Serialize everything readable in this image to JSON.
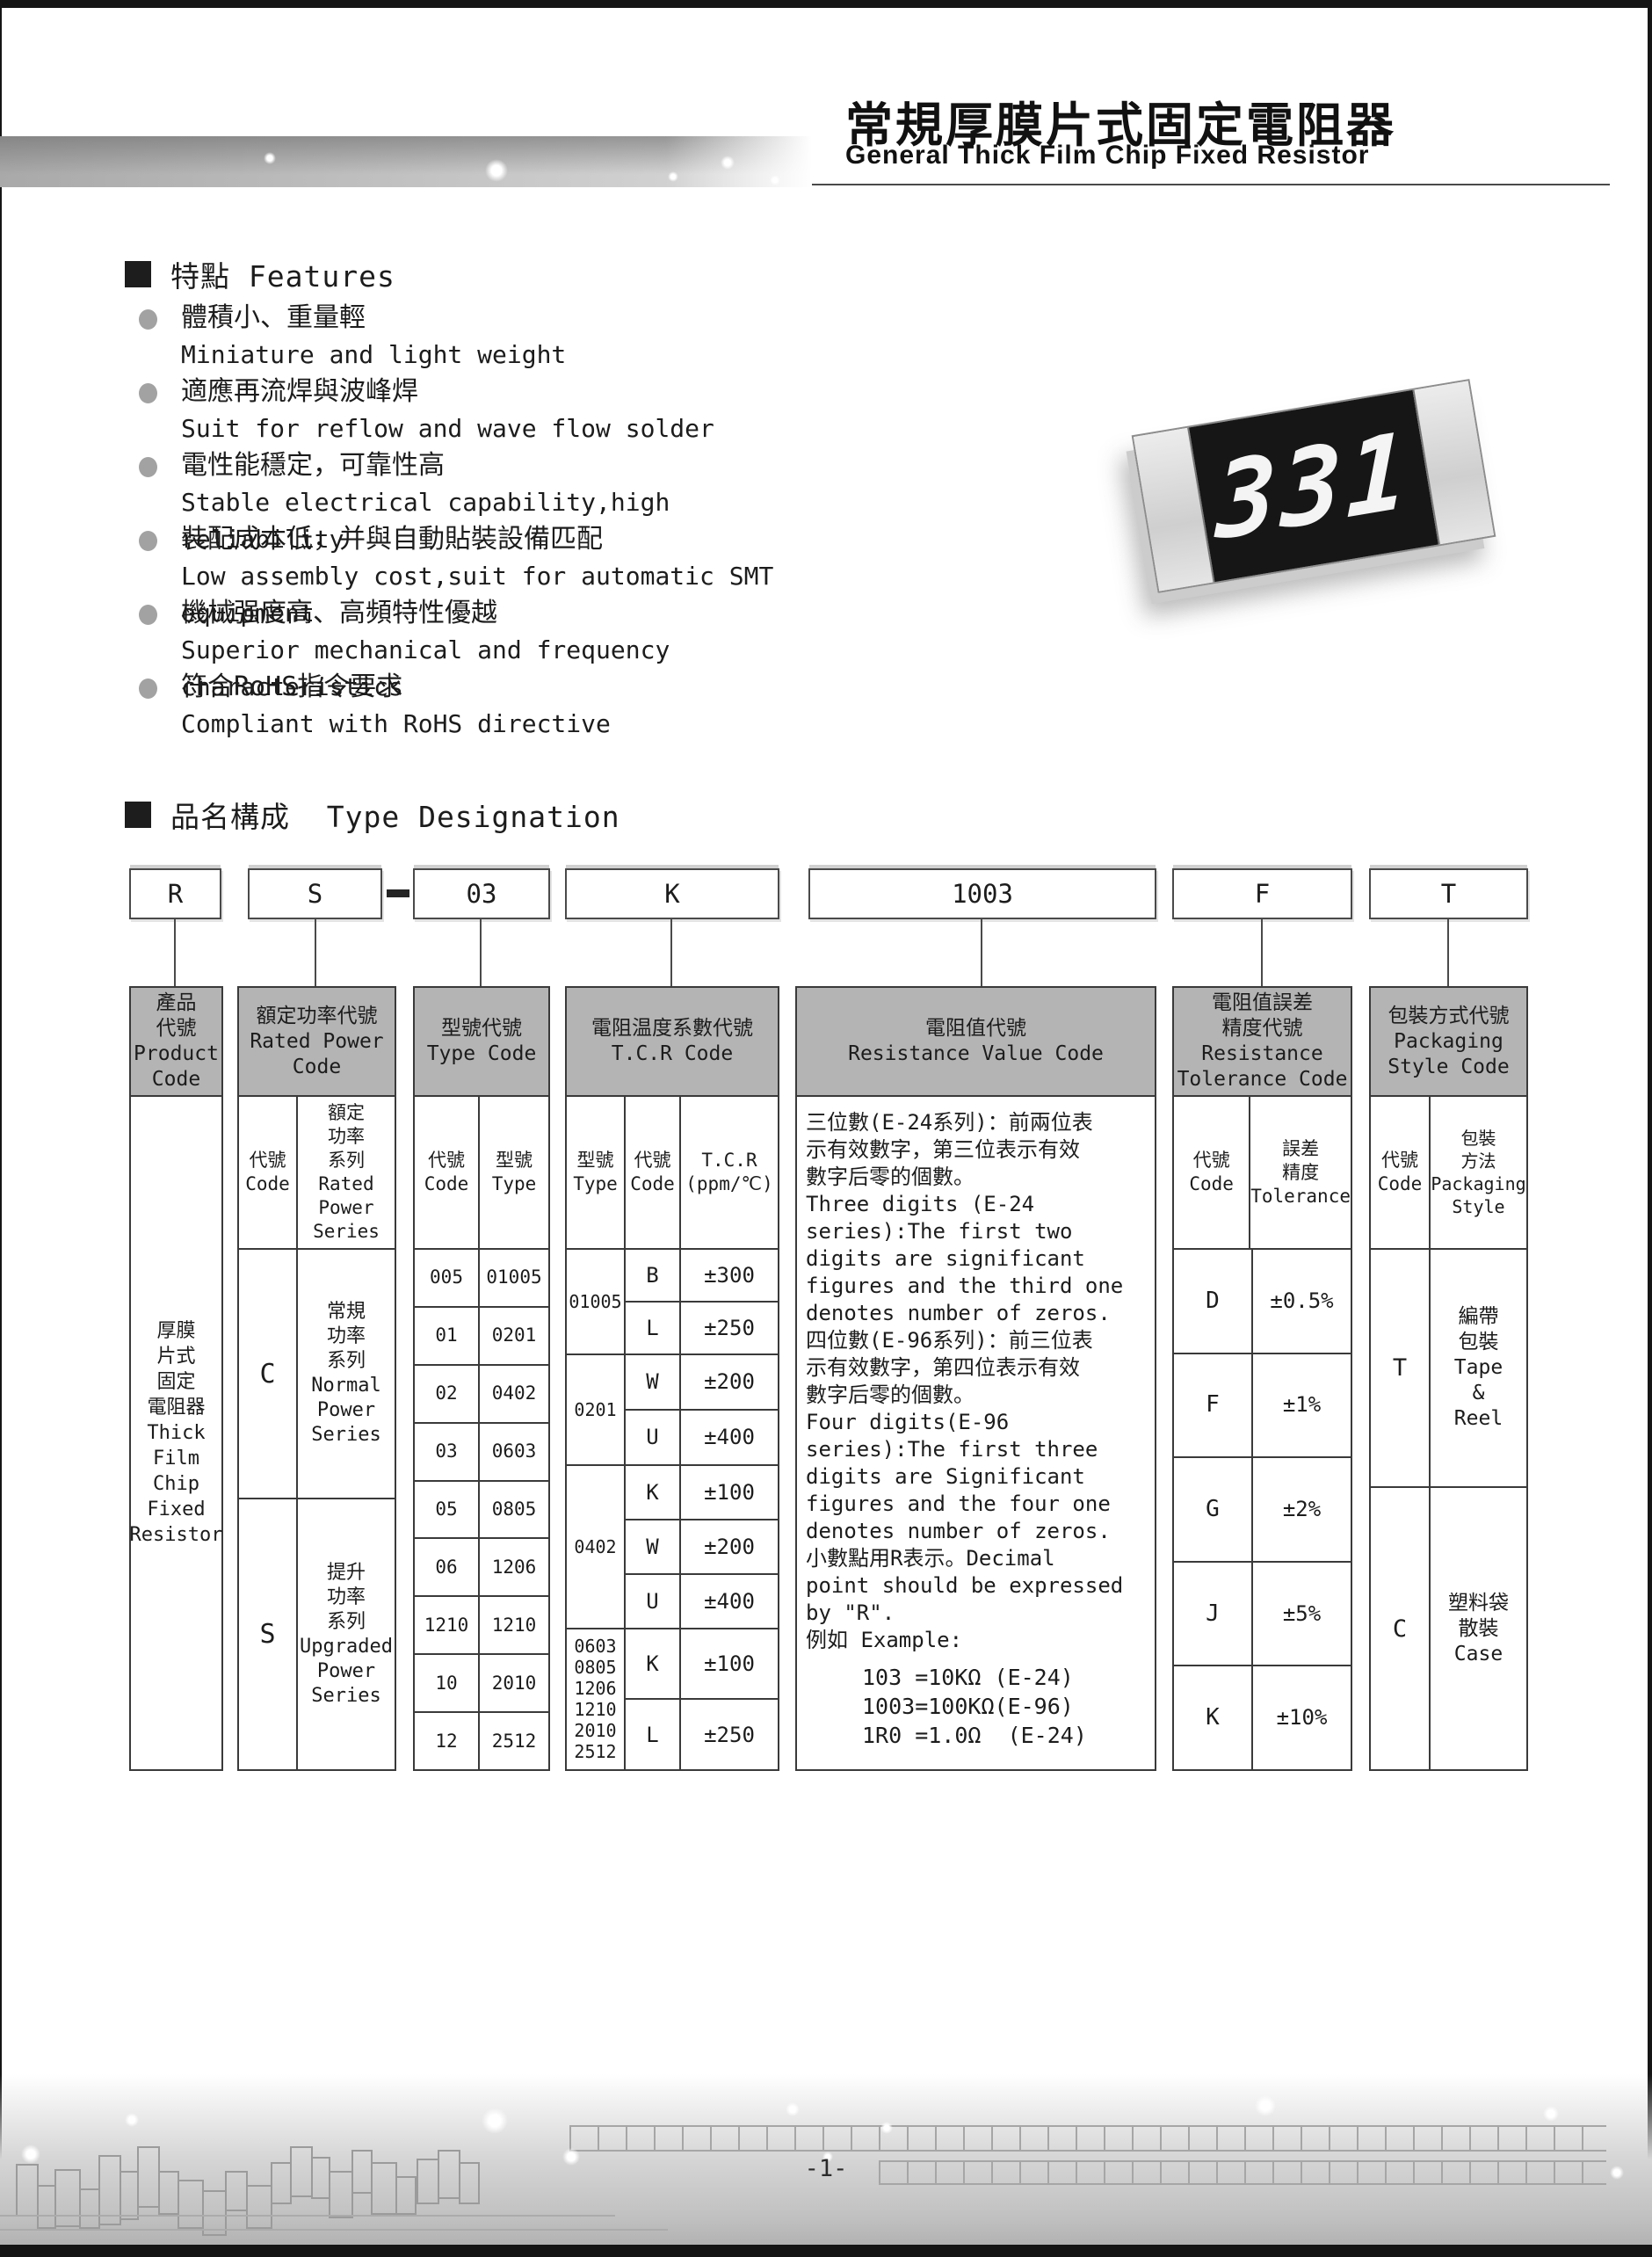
{
  "header": {
    "title_cn": "常規厚膜片式固定電阻器",
    "title_en": "General Thick Film Chip Fixed Resistor"
  },
  "chip": {
    "marking": "331"
  },
  "features": {
    "heading": "特點 Features",
    "items": [
      {
        "cn": "體積小、重量輕",
        "en": "Miniature and light weight"
      },
      {
        "cn": "適應再流焊與波峰焊",
        "en": "Suit for reflow and wave flow solder"
      },
      {
        "cn": "電性能穩定，可靠性高",
        "en": "Stable electrical capability,high reliability"
      },
      {
        "cn": "裝配成本低，并與自動貼裝設備匹配",
        "en": "Low assembly cost,suit for automatic SMT equipment"
      },
      {
        "cn": "機械强度高、高頻特性優越",
        "en": "Superior mechanical and frequency characteristics"
      },
      {
        "cn": "符合RoHS指令要求",
        "en": "Compliant with RoHS directive"
      }
    ]
  },
  "type_designation": {
    "heading": "品名構成  Type Designation",
    "codes": [
      "R",
      "S",
      "03",
      "K",
      "1003",
      "F",
      "T"
    ]
  },
  "columns": {
    "product": {
      "header": "產品\n代號\nProduct\nCode",
      "body": "厚膜\n片式\n固定\n電阻器\nThick\nFilm\nChip\nFixed\nResistor"
    },
    "rated_power": {
      "header": "額定功率代號\nRated Power\nCode",
      "sub_code": "代號\nCode",
      "sub_series": "額定\n功率\n系列\nRated\nPower\nSeries",
      "rows": [
        {
          "code": "C",
          "series": "常規\n功率\n系列\nNormal\nPower\nSeries"
        },
        {
          "code": "S",
          "series": "提升\n功率\n系列\nUpgraded\nPower\nSeries"
        }
      ]
    },
    "type_code": {
      "header": "型號代號\nType Code",
      "sub_code": "代號\nCode",
      "sub_type": "型號\nType",
      "rows": [
        {
          "code": "005",
          "type": "01005"
        },
        {
          "code": "01",
          "type": "0201"
        },
        {
          "code": "02",
          "type": "0402"
        },
        {
          "code": "03",
          "type": "0603"
        },
        {
          "code": "05",
          "type": "0805"
        },
        {
          "code": "06",
          "type": "1206"
        },
        {
          "code": "1210",
          "type": "1210"
        },
        {
          "code": "10",
          "type": "2010"
        },
        {
          "code": "12",
          "type": "2512"
        }
      ]
    },
    "tcr": {
      "header": "電阻温度系數代號\nT.C.R Code",
      "sub_type": "型號\nType",
      "sub_code": "代號\nCode",
      "sub_value": "T.C.R\n(ppm/℃)",
      "groups": [
        {
          "type": "01005",
          "rows": [
            {
              "code": "B",
              "value": "±300"
            },
            {
              "code": "L",
              "value": "±250"
            }
          ]
        },
        {
          "type": "0201",
          "rows": [
            {
              "code": "W",
              "value": "±200"
            },
            {
              "code": "U",
              "value": "±400"
            }
          ]
        },
        {
          "type": "0402",
          "rows": [
            {
              "code": "K",
              "value": "±100"
            },
            {
              "code": "W",
              "value": "±200"
            },
            {
              "code": "U",
              "value": "±400"
            }
          ]
        },
        {
          "type": "0603\n0805\n1206\n1210\n2010\n2512",
          "rows": [
            {
              "code": "K",
              "value": "±100"
            },
            {
              "code": "L",
              "value": "±250"
            }
          ]
        }
      ]
    },
    "resistance_value": {
      "header": "電阻值代號\nResistance Value Code",
      "body": "三位數(E-24系列)：前兩位表\n示有效數字，第三位表示有效\n數字后零的個數。\nThree digits (E-24\nseries):The first two\ndigits are significant\nfigures and the third one\ndenotes number of zeros.\n四位數(E-96系列)：前三位表\n示有效數字，第四位表示有效\n數字后零的個數。\nFour digits(E-96\nseries):The first three\ndigits are Significant\nfigures and the four one\ndenotes number of zeros.\n小數點用R表示。Decimal\npoint should be expressed\nby \"R\".\n例如 Example:",
      "examples": "103 =10KΩ (E-24)\n1003=100KΩ(E-96)\n1R0 =1.0Ω  (E-24)"
    },
    "tolerance": {
      "header": "電阻值誤差\n精度代號\nResistance\nTolerance Code",
      "sub_code": "代號\nCode",
      "sub_tol": "誤差\n精度\nTolerance",
      "rows": [
        {
          "code": "D",
          "value": "±0.5%"
        },
        {
          "code": "F",
          "value": "±1%"
        },
        {
          "code": "G",
          "value": "±2%"
        },
        {
          "code": "J",
          "value": "±5%"
        },
        {
          "code": "K",
          "value": "±10%"
        }
      ]
    },
    "packaging": {
      "header": "包裝方式代號\nPackaging\nStyle Code",
      "sub_code": "代號\nCode",
      "sub_style": "包裝\n方法\nPackaging\nStyle",
      "rows": [
        {
          "code": "T",
          "style": "編帶\n包裝\nTape\n&\nReel"
        },
        {
          "code": "C",
          "style": "塑料袋\n散裝\nCase"
        }
      ]
    }
  },
  "footer": {
    "page_number": "-1-"
  }
}
